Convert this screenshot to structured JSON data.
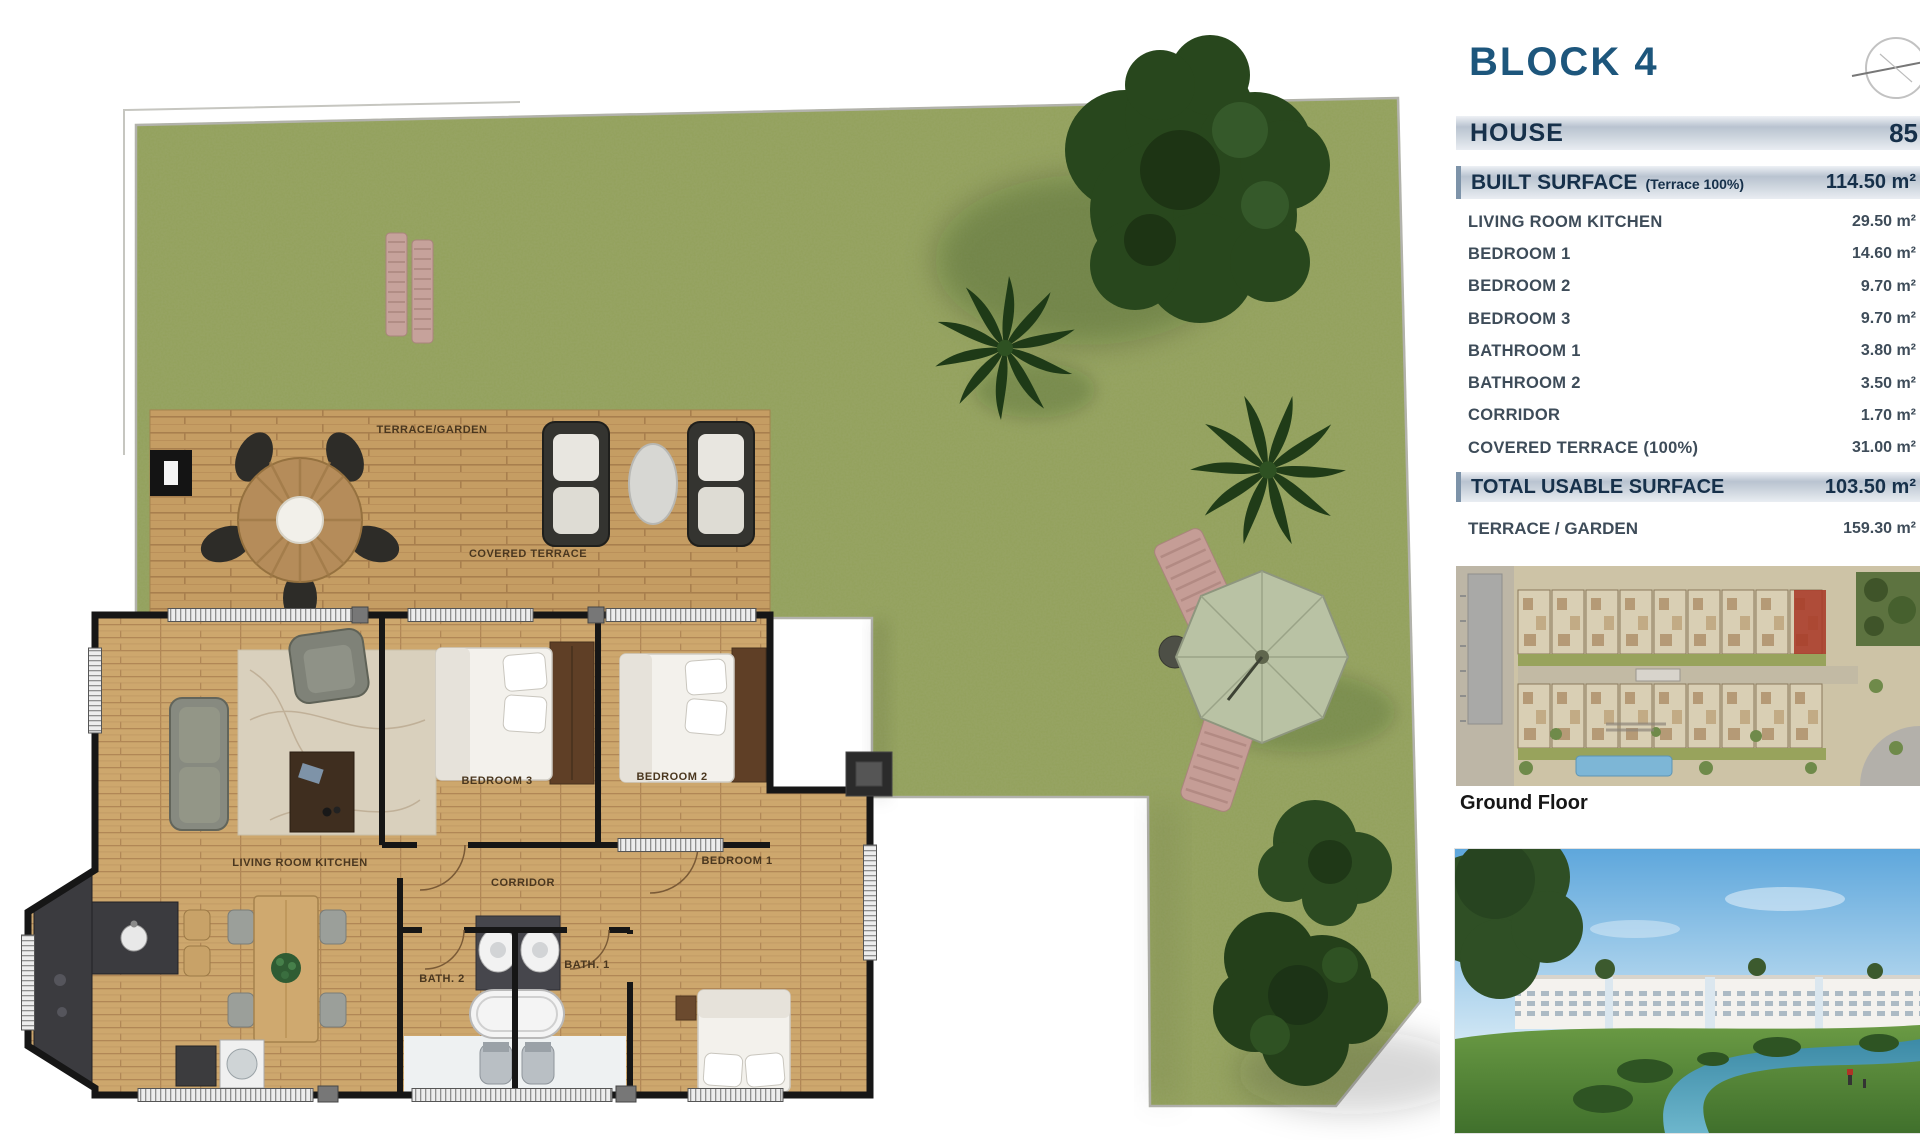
{
  "plan": {
    "labels": {
      "terrace_garden": "TERRACE/GARDEN",
      "covered_terrace": "COVERED TERRACE",
      "living": "LIVING ROOM KITCHEN",
      "bedroom3": "BEDROOM 3",
      "bedroom2": "BEDROOM 2",
      "bedroom1": "BEDROOM 1",
      "corridor": "CORRIDOR",
      "bath2": "BATH. 2",
      "bath1": "BATH. 1"
    }
  },
  "sidebar": {
    "title": "BLOCK 4",
    "house": {
      "label": "HOUSE",
      "value": "85"
    },
    "built": {
      "label": "BUILT SURFACE",
      "note": "(Terrace 100%)",
      "value": "114.50 m²"
    },
    "rooms": [
      {
        "label": "LIVING ROOM KITCHEN",
        "value": "29.50 m²"
      },
      {
        "label": "BEDROOM 1",
        "value": "14.60 m²"
      },
      {
        "label": "BEDROOM 2",
        "value": "9.70 m²"
      },
      {
        "label": "BEDROOM 3",
        "value": "9.70 m²"
      },
      {
        "label": "BATHROOM 1",
        "value": "3.80 m²"
      },
      {
        "label": "BATHROOM 2",
        "value": "3.50 m²"
      },
      {
        "label": "CORRIDOR",
        "value": "1.70 m²"
      },
      {
        "label": "COVERED TERRACE (100%)",
        "value": "31.00 m²"
      }
    ],
    "total": {
      "label": "TOTAL USABLE SURFACE",
      "value": "103.50 m²"
    },
    "terrace": {
      "label": "TERRACE / GARDEN",
      "value": "159.30 m²"
    },
    "ground_floor_caption": "Ground Floor"
  },
  "colors": {
    "accent_blue": "#1d567c",
    "bar_text": "#16304a",
    "grass": "#93a05a",
    "deck_wood": "#c59d63",
    "wall": "#161616",
    "highlight_unit_red": "#a83a28"
  }
}
